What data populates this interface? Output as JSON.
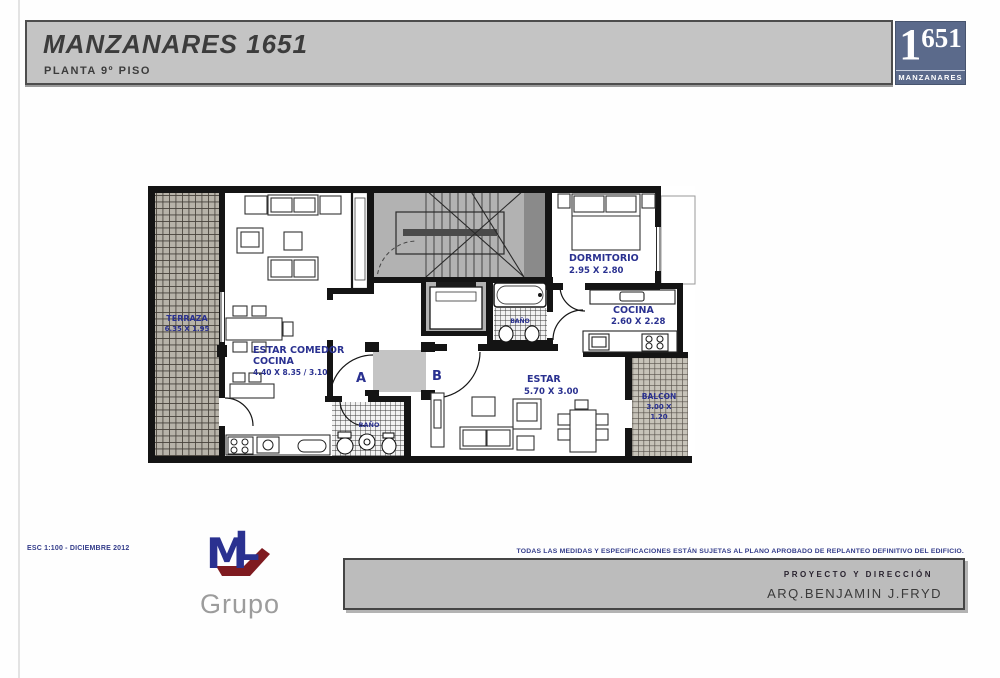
{
  "header": {
    "title": "MANZANARES 1651",
    "subtitle": "PLANTA 9º PISO"
  },
  "logo": {
    "big_digit": "1",
    "rest_digits": "651",
    "name": "MANZANARES"
  },
  "plan": {
    "terraza": {
      "name": "TERRAZA",
      "dims": "6.35 X 1.95"
    },
    "estar_comedor": {
      "line1": "ESTAR COMEDOR",
      "line2": "COCINA",
      "dims": "4.40 X 8.35 / 3.10"
    },
    "bano_a": {
      "name": "BAÑO"
    },
    "bano_b": {
      "name": "BAÑO"
    },
    "dormitorio": {
      "name": "DORMITORIO",
      "dims": "2.95 X 2.80"
    },
    "cocina_b": {
      "name": "COCINA",
      "dims": "2.60 X 2.28"
    },
    "estar_b": {
      "name": "ESTAR",
      "dims": "5.70 X 3.00"
    },
    "balcon": {
      "name": "BALCON",
      "dims_line1": "3.00 X",
      "dims_line2": "1.20"
    },
    "markers": {
      "a": "A",
      "b": "B"
    }
  },
  "footer": {
    "scale_note": "ESC 1:100 - DICIEMBRE 2012",
    "brand": {
      "mark_m": "M",
      "mark_l": "L",
      "name": "Grupo"
    },
    "disclaimer": "TODAS LAS MEDIDAS Y ESPECIFICACIONES ESTÁN SUJETAS AL PLANO APROBADO DE REPLANTEO DEFINITIVO DEL EDIFICIO.",
    "credit_title": "PROYECTO Y DIRECCIÓN",
    "credit_name": "ARQ.BENJAMIN J.FRYD"
  },
  "colors": {
    "logo_blue": "#5b6a8b",
    "brand_red": "#c5242b",
    "label_navy": "#2a3190"
  }
}
